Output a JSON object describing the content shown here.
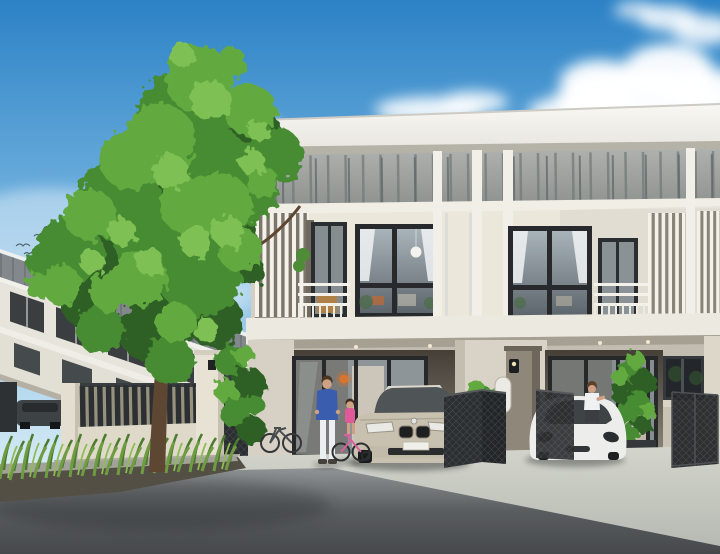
{
  "scene": {
    "type": "3d-architectural-rendering",
    "subject": "Modern two-story townhouse block with carports, residents, parked cars, large tree, perimeter fence and asphalt street",
    "objects": [
      "sky",
      "clouds",
      "flying-birds",
      "large-tree",
      "background-townhouse-row",
      "parked-dark-car",
      "perimeter-fence",
      "fence-gate",
      "main-townhouse-block",
      "flat-roof",
      "facade-band",
      "louver-balconies",
      "bedroom-windows",
      "carport-unit-1",
      "carport-unit-2",
      "glass-sliding-doors",
      "gate-pillar",
      "mailbox",
      "folded-mesh-gates",
      "champagne-sedan",
      "white-hatchback",
      "man",
      "child-on-bicycle",
      "woman",
      "leaning-bicycle",
      "potted-plants",
      "grass-strip",
      "concrete-driveway",
      "asphalt-road"
    ]
  },
  "palette": {
    "sky_top": "#2c82c6",
    "sky_mid": "#7db9e2",
    "sky_horizon": "#d8ecf6",
    "cloud_white": "#ffffff",
    "band_light": "#aeb1ae",
    "band_dark": "#8d918e",
    "band_stripe": "#747a7a",
    "pilaster_white": "#f2efe8",
    "wall_cream": "#ece7db",
    "slab_white": "#ece9e0",
    "window_frame": "#27292c",
    "glass_light": "#a9b4ba",
    "glass_dark": "#5d666c",
    "curtain_white": "#eef0f1",
    "louver_white": "#f3f1ea",
    "louver_shadow": "#7c766a",
    "recess_dark": "#4f4b44",
    "recess_light": "#938d80",
    "pillar_taupe": "#8f877a",
    "gate_dark": "#2c2f31",
    "fence_slat_dark": "#2d3033",
    "fence_base_cream": "#ded9c8",
    "bg_band_gray": "#82888b",
    "bg_wall": "#e7e4db",
    "bg_window": "#3a3e40",
    "tree_dark": "#2f6125",
    "tree_mid": "#468c31",
    "tree_light": "#62aa3f",
    "tree_highlight": "#7fc055",
    "trunk_brown": "#5d4733",
    "grass_back": "#4c7a2e",
    "grass_front": "#6f9c42",
    "grass_light": "#8fbb55",
    "soil_dark": "#534f45",
    "curb_gray": "#a3a29a",
    "apron_light": "#d3d5cd",
    "apron_dark": "#b7bab2",
    "road_light": "#909495",
    "road_dark": "#46494b",
    "car_champagne": "#c9c1b0",
    "car_glass": "#4f5456",
    "car_white": "#edeeec",
    "lamp_orange": "#d8742c",
    "jacket_blue": "#3b5dae",
    "pants_white": "#eceff2",
    "dress_pink": "#e05a9a",
    "skin": "#cfa184",
    "hair_brown": "#5a4228",
    "plant_green": "#3f7a34"
  }
}
